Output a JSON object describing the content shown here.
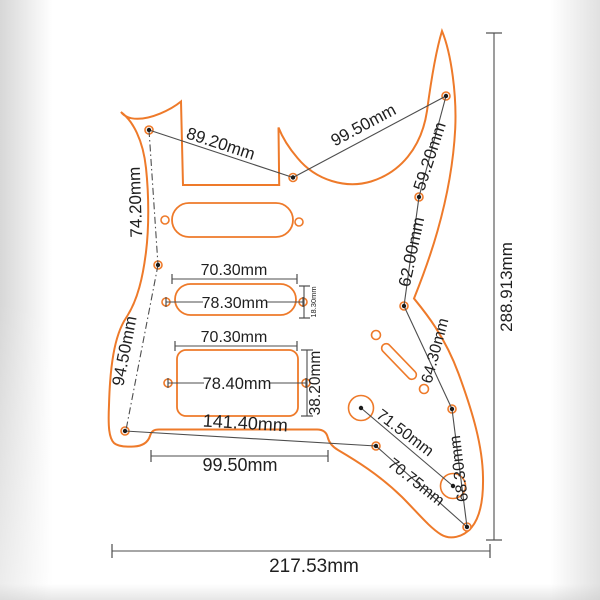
{
  "diagram_type": "guitar-pickguard-dimension-drawing",
  "colors": {
    "outline_orange": "#ee7a2a",
    "dimension_gray": "#4d4d4d",
    "label_text": "#1f1f1f",
    "background": "#ffffff"
  },
  "dims": {
    "horn_spacing_top": "89.20mm",
    "pocket_to_upper_horn": "99.50mm",
    "upper_left_edge": "74.20mm",
    "lower_left_edge": "94.50mm",
    "upper_right_horn": "59.20mm",
    "upper_right_edge": "62.00mm",
    "mid_right_edge": "64.30mm",
    "lower_right_edge": "68.30mm",
    "pot_spacing": "71.50mm",
    "bottom_to_corner": "70.75mm",
    "bottom_span": "141.40mm",
    "trem_cutout_width": "99.50mm",
    "overall_width": "217.53mm",
    "overall_height": "288.913mm",
    "single_coil_width": "70.30mm",
    "single_coil_screw_span": "78.30mm",
    "single_coil_height": "18.30mm",
    "humbucker_width": "70.30mm",
    "humbucker_screw_span": "78.40mm",
    "humbucker_height": "38.20mm"
  }
}
